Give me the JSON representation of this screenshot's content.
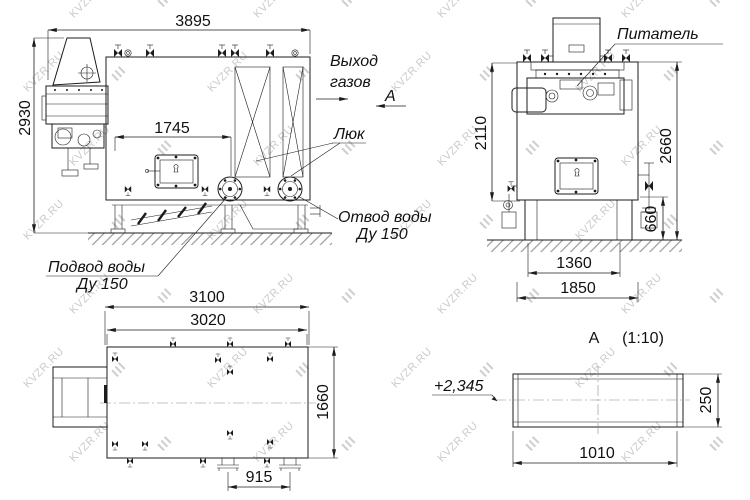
{
  "watermark": {
    "text": "KVZR.RU"
  },
  "front": {
    "dim_width": "3895",
    "dim_height": "2930",
    "dim_firebox": "1745",
    "gas_line1": "Выход",
    "gas_line2": "газов",
    "section_mark": "А",
    "hatch_label": "Люк",
    "outlet_line1": "Отвод воды",
    "outlet_line2": "Ду 150",
    "inlet_line1": "Подвод воды",
    "inlet_line2": "Ду 150"
  },
  "side": {
    "feeder_label": "Питатель",
    "dim_upper": "2110",
    "dim_total": "2660",
    "dim_base": "660",
    "dim_support": "1360",
    "dim_foundation": "1850"
  },
  "plan": {
    "dim_total": "3100",
    "dim_body": "3020",
    "dim_depth": "1660",
    "dim_flanges": "915"
  },
  "detail": {
    "title": "А",
    "scale": "(1:10)",
    "elevation": "+2,345",
    "dim_height": "250",
    "dim_width": "1010"
  }
}
